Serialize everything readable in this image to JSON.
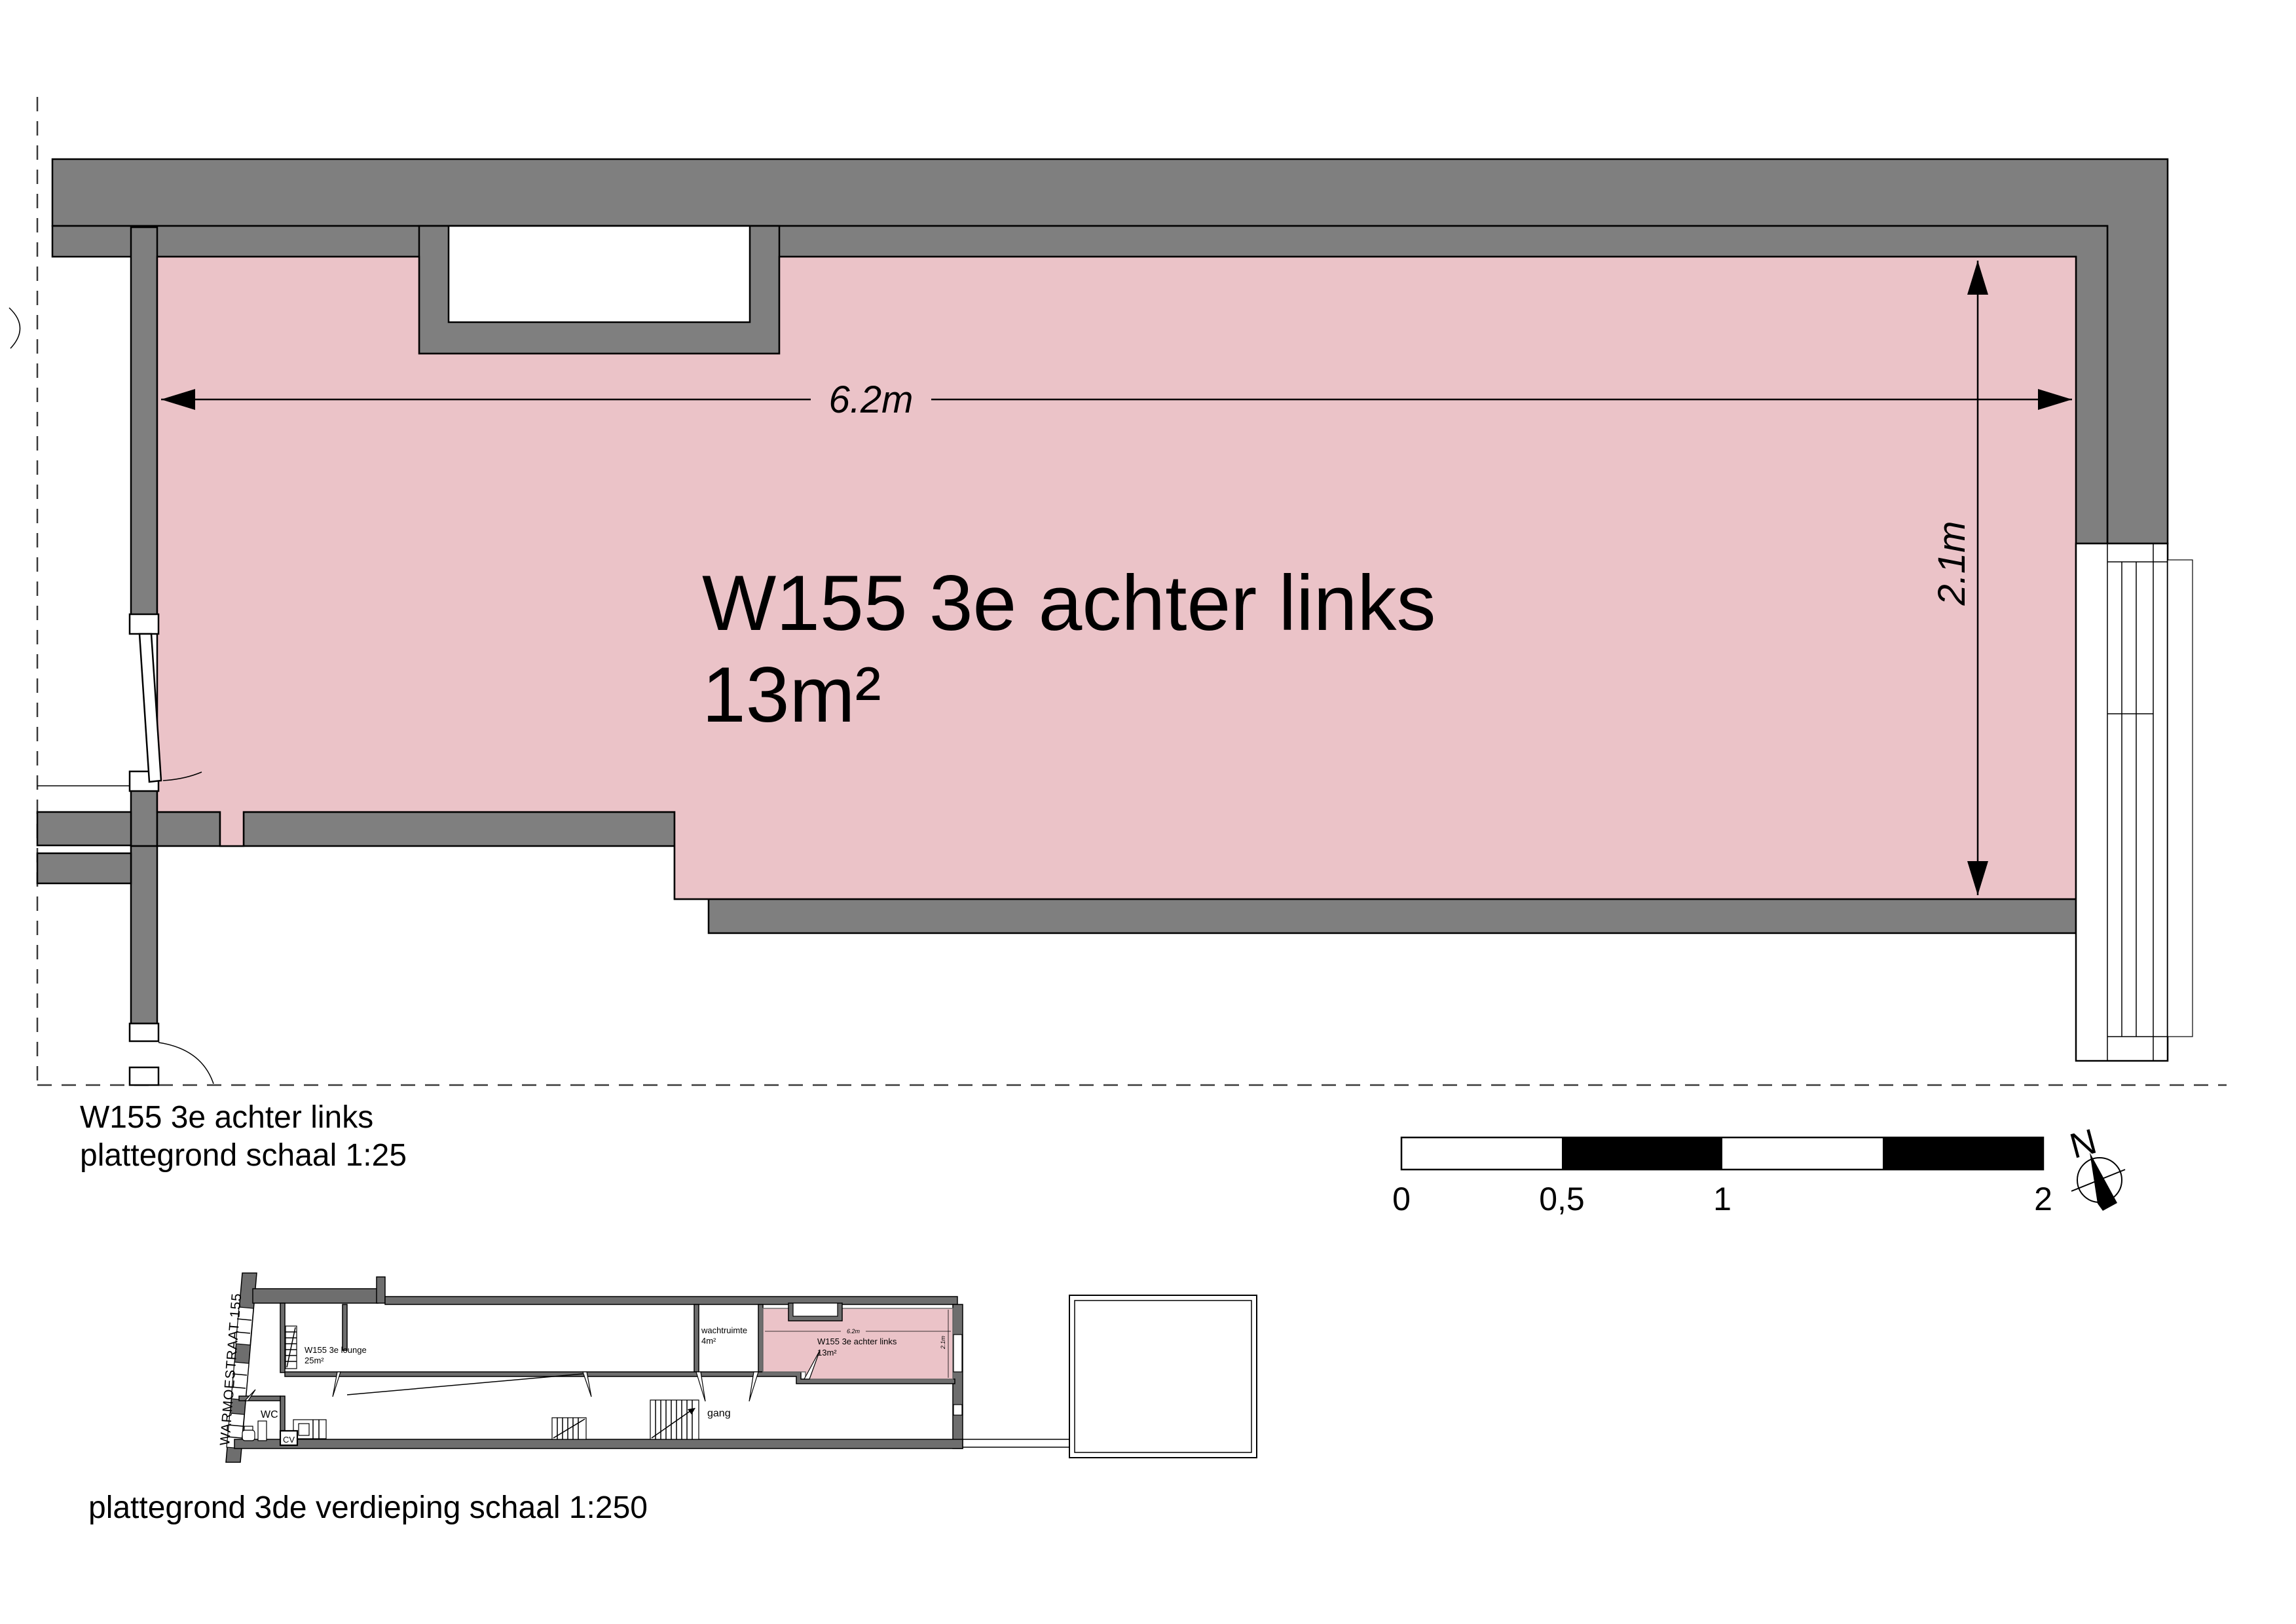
{
  "main_plan": {
    "room_label_line1": "W155 3e achter links",
    "room_label_line2": "13m²",
    "dimension_width": "6.2m",
    "dimension_height": "2.1m"
  },
  "caption_top": {
    "line1": "W155 3e achter links",
    "line2": "plattegrond schaal 1:25"
  },
  "scale_bar": {
    "labels": [
      "0",
      "0,5",
      "1",
      "2"
    ]
  },
  "north_arrow": {
    "label": "N"
  },
  "overview_plan": {
    "street_label": "WARMOESTRAAT 155",
    "wc_label": "WC",
    "cv_label": "CV",
    "gang_label": "gang",
    "wachtruimte_label": "wachtruimte",
    "wachtruimte_area": "4m²",
    "lounge_label": "W155 3e lounge",
    "lounge_area": "25m²",
    "room_label": "W155 3e achter links",
    "room_area": "13m²",
    "dim_width": "6.2m",
    "dim_height": "2.1m"
  },
  "caption_bottom": {
    "line1": "plattegrond 3de verdieping schaal 1:250"
  },
  "colors": {
    "room_highlight": "#ebc3c8",
    "wall_gray": "#7f7f7f",
    "overview_wall_gray": "#6e6e6e"
  }
}
